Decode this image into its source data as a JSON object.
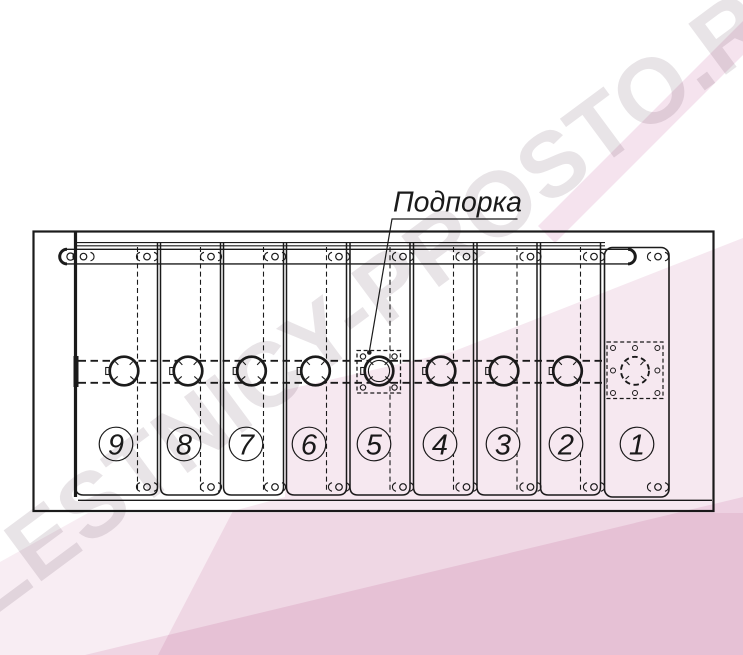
{
  "figure": {
    "callout_label": "Подпорка",
    "panels": [
      {
        "number": "9"
      },
      {
        "number": "8"
      },
      {
        "number": "7"
      },
      {
        "number": "6"
      },
      {
        "number": "5"
      },
      {
        "number": "4"
      },
      {
        "number": "3"
      },
      {
        "number": "2"
      },
      {
        "number": "1"
      }
    ]
  },
  "watermark": {
    "text": "LESTNICY-PROSTO.RU"
  },
  "colors": {
    "line": "#1b1b1b",
    "pink_light": "#f8edf3",
    "pink_mid": "#f3dcea",
    "watermark_text": "#e8e4e7"
  }
}
